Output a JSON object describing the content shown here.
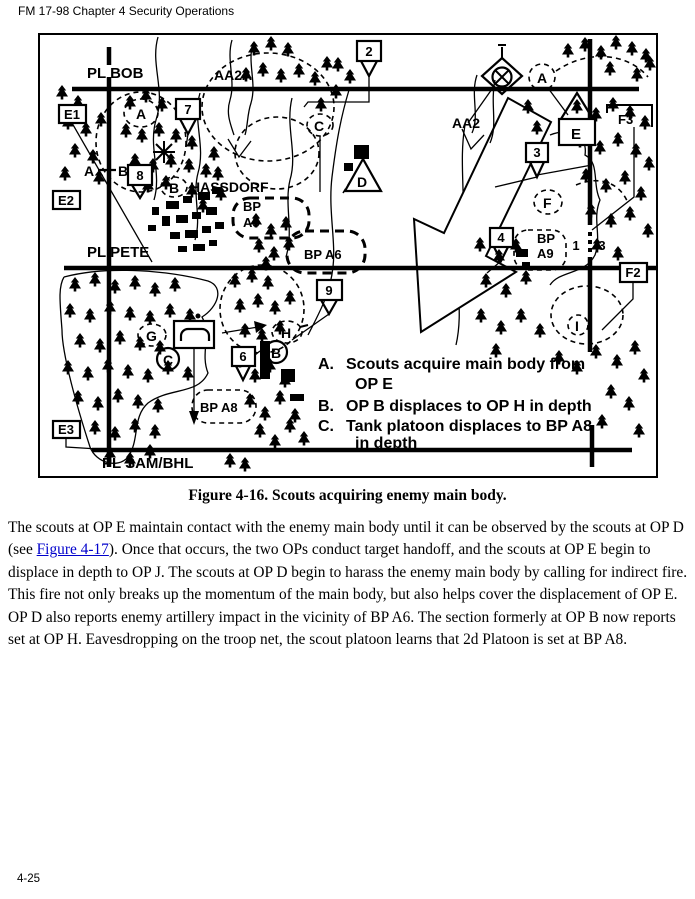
{
  "page": {
    "header": "FM 17-98 Chapter 4 Security Operations",
    "page_number": "4-25"
  },
  "figure": {
    "caption": "Figure 4-16. Scouts acquiring enemy main body.",
    "phase_lines": {
      "bob": "PL BOB",
      "pete": "PL PETE",
      "sam": "PL SAM/BHL"
    },
    "avenues": {
      "aa2a": "AA2A",
      "aa2": "AA2"
    },
    "town": "HASSDORF",
    "battle_positions": {
      "a5_l1": "BP",
      "a5_l2": "A5",
      "a6": "BP A6",
      "a8": "BP A8",
      "a9_l1": "BP",
      "a9_l2": "A9"
    },
    "targets": {
      "e1": "E1",
      "e2": "E2",
      "e3": "E3",
      "f2": "F2",
      "f3": "F3",
      "n2": "2",
      "n3": "3",
      "n4": "4",
      "n6": "6",
      "n7": "7",
      "n8": "8",
      "n9": "9"
    },
    "ops": {
      "a": "A",
      "b": "B",
      "c": "C",
      "d": "D",
      "e": "E",
      "f": "F",
      "g": "G",
      "h": "H",
      "i": "I"
    },
    "checkpoints": {
      "circle_a": "A",
      "circle_b": "B",
      "circle_c": "C"
    },
    "ab_target": {
      "a": "A",
      "b": "B"
    },
    "boundary": {
      "left": "1",
      "right": "3"
    },
    "legend": {
      "a_label": "A.",
      "a_text1": "Scouts acquire main body from",
      "a_text2": "OP E",
      "b_label": "B.",
      "b_text": "OP B displaces to OP H in depth",
      "c_label": "C.",
      "c_text1": "Tank platoon displaces to BP A8",
      "c_text2": "in depth"
    }
  },
  "body": {
    "p1_before_link": "The scouts at OP E maintain contact with the enemy main body until it can be observed by the scouts at OP D (see ",
    "p1_link": "Figure 4-17",
    "p1_after_link": "). Once that occurs, the two OPs conduct target handoff, and the scouts at OP E begin to displace in depth to OP J. The scouts at OP D begin to harass the enemy main body by calling for indirect fire. This fire not only breaks up the momentum of the main body, but also helps cover the displacement of OP E. OP D also reports enemy artillery impact in the vicinity of BP A6. The section formerly at OP B now reports set at OP H. Eavesdropping on the troop net, the scout platoon learns that 2d Platoon is set at BP A8."
  },
  "colors": {
    "ink": "#000000",
    "paper": "#ffffff",
    "link": "#0000cc"
  }
}
